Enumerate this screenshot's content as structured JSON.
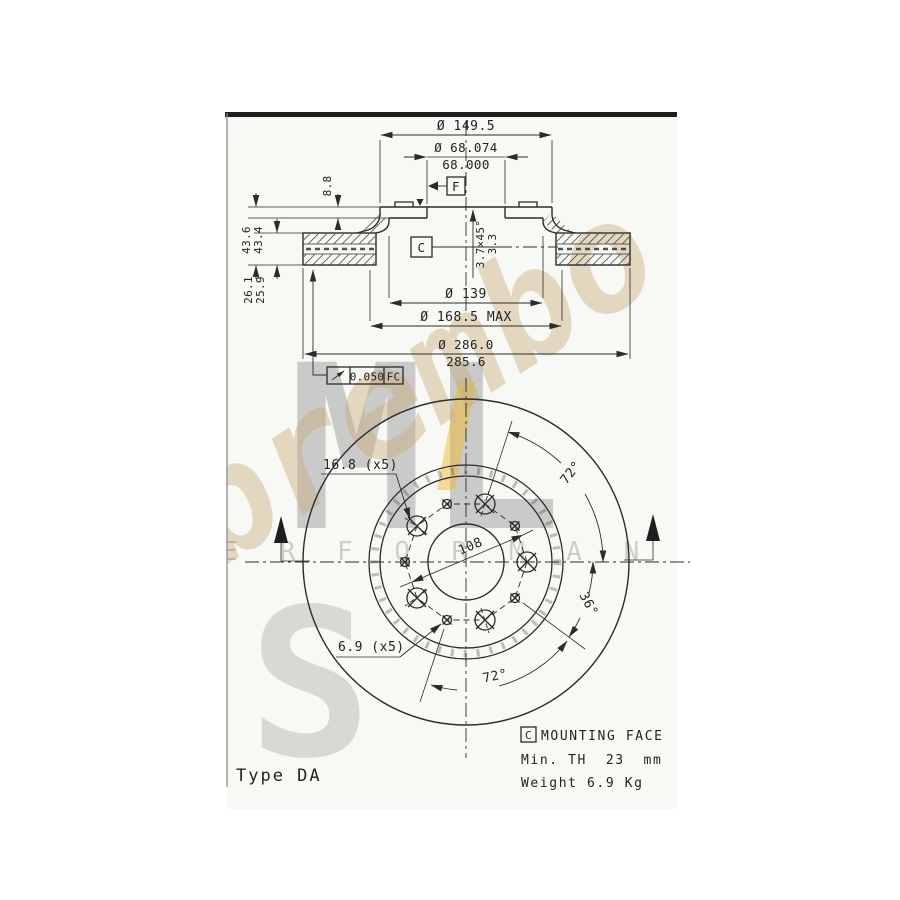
{
  "colors": {
    "line": "#2b2b2b",
    "top_bar": "#1f1f1f",
    "drawing_background": "#f8f8f5",
    "brand_tan": "#c6aa76",
    "accent_yellow": "#ecbb33",
    "watermark_gray": "#9a9a9a"
  },
  "watermark": {
    "brand": "brembo.",
    "letters": "ML",
    "word": "P E R F O R M A N C E",
    "emblem": "S"
  },
  "section": {
    "outer_top": "Ø 149.5",
    "bore_a": "Ø 68.074",
    "bore_b": "68.000",
    "plate": "8.8",
    "height_a": "43.6",
    "height_b": "43.4",
    "band_a": "26.1",
    "band_b": "25.9",
    "chamfer_a": "3.7×45°",
    "chamfer_b": "3.3",
    "pcd": "Ø 139",
    "hub_max": "Ø 168.5 MAX",
    "od_a": "Ø 286.0",
    "od_b": "285.6",
    "datum_f": "F",
    "datum_c": "C",
    "runout_value": "0.050",
    "runout_ref": "FC"
  },
  "front": {
    "hole_large": "16.8 (x5)",
    "hole_small": "6.9 (x5)",
    "pcd": "108",
    "angle_top": "72°",
    "angle_right": "36°",
    "angle_bottom": "72°"
  },
  "notes": {
    "datum": "C",
    "mounting": "MOUNTING FACE",
    "min_th": "Min. TH  23  mm",
    "weight": "Weight 6.9 Kg",
    "type_label": "Type DA"
  }
}
